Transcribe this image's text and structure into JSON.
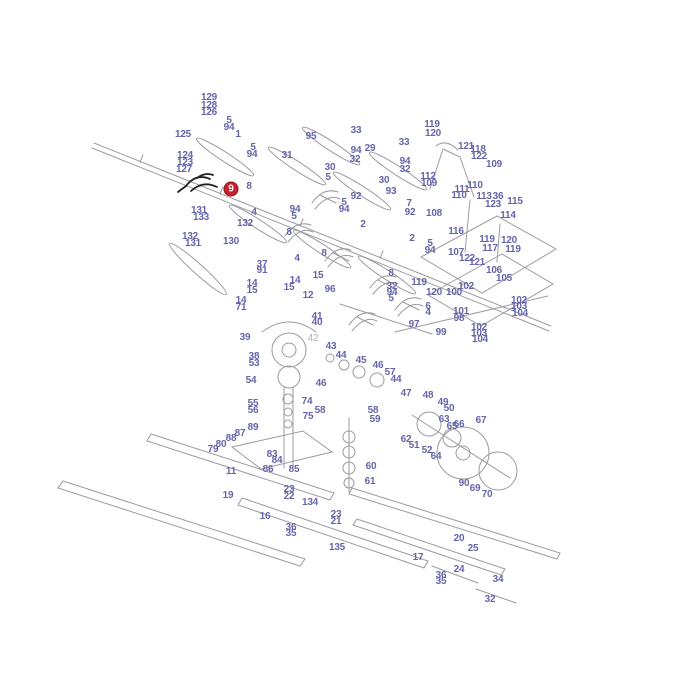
{
  "page": {
    "background": "#ffffff",
    "label_color": "#6565aa",
    "muted_label_color": "#b1b1c4",
    "highlight_color": "#c81f2e",
    "line_color": "#9b9ba3"
  },
  "highlighted_label": {
    "text": "9",
    "x": 231,
    "y": 189
  },
  "labels": [
    {
      "t": "129",
      "x": 209,
      "y": 98
    },
    {
      "t": "128",
      "x": 209,
      "y": 106
    },
    {
      "t": "126",
      "x": 209,
      "y": 113
    },
    {
      "t": "125",
      "x": 183,
      "y": 135
    },
    {
      "t": "5",
      "x": 229,
      "y": 121
    },
    {
      "t": "94",
      "x": 229,
      "y": 128
    },
    {
      "t": "1",
      "x": 238,
      "y": 135
    },
    {
      "t": "124",
      "x": 185,
      "y": 156
    },
    {
      "t": "123",
      "x": 185,
      "y": 163
    },
    {
      "t": "127",
      "x": 184,
      "y": 170
    },
    {
      "t": "8",
      "x": 249,
      "y": 187
    },
    {
      "t": "131",
      "x": 199,
      "y": 211
    },
    {
      "t": "133",
      "x": 201,
      "y": 218
    },
    {
      "t": "4",
      "x": 254,
      "y": 213
    },
    {
      "t": "132",
      "x": 245,
      "y": 224
    },
    {
      "t": "132",
      "x": 190,
      "y": 237
    },
    {
      "t": "131",
      "x": 193,
      "y": 244
    },
    {
      "t": "130",
      "x": 231,
      "y": 242
    },
    {
      "t": "5",
      "x": 253,
      "y": 148
    },
    {
      "t": "94",
      "x": 252,
      "y": 155
    },
    {
      "t": "31",
      "x": 287,
      "y": 156
    },
    {
      "t": "95",
      "x": 311,
      "y": 137
    },
    {
      "t": "33",
      "x": 356,
      "y": 131
    },
    {
      "t": "29",
      "x": 370,
      "y": 149
    },
    {
      "t": "94",
      "x": 356,
      "y": 151
    },
    {
      "t": "32",
      "x": 355,
      "y": 160
    },
    {
      "t": "30",
      "x": 330,
      "y": 168
    },
    {
      "t": "5",
      "x": 328,
      "y": 178
    },
    {
      "t": "33",
      "x": 404,
      "y": 143
    },
    {
      "t": "94",
      "x": 405,
      "y": 162
    },
    {
      "t": "32",
      "x": 405,
      "y": 170
    },
    {
      "t": "30",
      "x": 384,
      "y": 181
    },
    {
      "t": "92",
      "x": 356,
      "y": 197
    },
    {
      "t": "93",
      "x": 391,
      "y": 192
    },
    {
      "t": "5",
      "x": 344,
      "y": 203
    },
    {
      "t": "94",
      "x": 344,
      "y": 210
    },
    {
      "t": "94",
      "x": 295,
      "y": 210
    },
    {
      "t": "5",
      "x": 294,
      "y": 217
    },
    {
      "t": "2",
      "x": 363,
      "y": 225
    },
    {
      "t": "7",
      "x": 409,
      "y": 204
    },
    {
      "t": "92",
      "x": 410,
      "y": 213
    },
    {
      "t": "2",
      "x": 412,
      "y": 239
    },
    {
      "t": "8",
      "x": 289,
      "y": 233
    },
    {
      "t": "8",
      "x": 324,
      "y": 254
    },
    {
      "t": "4",
      "x": 297,
      "y": 259
    },
    {
      "t": "8",
      "x": 391,
      "y": 274
    },
    {
      "t": "32",
      "x": 392,
      "y": 287
    },
    {
      "t": "94",
      "x": 392,
      "y": 293
    },
    {
      "t": "5",
      "x": 391,
      "y": 299
    },
    {
      "t": "96",
      "x": 330,
      "y": 290
    },
    {
      "t": "15",
      "x": 318,
      "y": 276
    },
    {
      "t": "14",
      "x": 295,
      "y": 281
    },
    {
      "t": "15",
      "x": 289,
      "y": 288
    },
    {
      "t": "12",
      "x": 308,
      "y": 296
    },
    {
      "t": "37",
      "x": 262,
      "y": 265
    },
    {
      "t": "91",
      "x": 262,
      "y": 271
    },
    {
      "t": "14",
      "x": 252,
      "y": 284
    },
    {
      "t": "15",
      "x": 252,
      "y": 291
    },
    {
      "t": "14",
      "x": 241,
      "y": 301
    },
    {
      "t": "71",
      "x": 241,
      "y": 308
    },
    {
      "t": "41",
      "x": 317,
      "y": 317
    },
    {
      "t": "40",
      "x": 317,
      "y": 323
    },
    {
      "t": "39",
      "x": 245,
      "y": 338
    },
    {
      "t": "42",
      "x": 313,
      "y": 339,
      "muted": true
    },
    {
      "t": "38",
      "x": 254,
      "y": 357
    },
    {
      "t": "53",
      "x": 254,
      "y": 364
    },
    {
      "t": "54",
      "x": 251,
      "y": 381
    },
    {
      "t": "55",
      "x": 253,
      "y": 404
    },
    {
      "t": "56",
      "x": 253,
      "y": 411
    },
    {
      "t": "43",
      "x": 331,
      "y": 347
    },
    {
      "t": "44",
      "x": 341,
      "y": 356
    },
    {
      "t": "45",
      "x": 361,
      "y": 361
    },
    {
      "t": "46",
      "x": 378,
      "y": 366
    },
    {
      "t": "57",
      "x": 390,
      "y": 373
    },
    {
      "t": "44",
      "x": 396,
      "y": 380
    },
    {
      "t": "46",
      "x": 321,
      "y": 384
    },
    {
      "t": "74",
      "x": 307,
      "y": 402
    },
    {
      "t": "58",
      "x": 320,
      "y": 411
    },
    {
      "t": "75",
      "x": 308,
      "y": 417
    },
    {
      "t": "58",
      "x": 373,
      "y": 411
    },
    {
      "t": "59",
      "x": 375,
      "y": 420
    },
    {
      "t": "60",
      "x": 371,
      "y": 467
    },
    {
      "t": "61",
      "x": 370,
      "y": 482
    },
    {
      "t": "47",
      "x": 406,
      "y": 394
    },
    {
      "t": "48",
      "x": 428,
      "y": 396
    },
    {
      "t": "49",
      "x": 443,
      "y": 403
    },
    {
      "t": "50",
      "x": 449,
      "y": 409
    },
    {
      "t": "63",
      "x": 444,
      "y": 420
    },
    {
      "t": "65",
      "x": 452,
      "y": 427
    },
    {
      "t": "66",
      "x": 459,
      "y": 425
    },
    {
      "t": "67",
      "x": 481,
      "y": 421
    },
    {
      "t": "62",
      "x": 406,
      "y": 440
    },
    {
      "t": "51",
      "x": 414,
      "y": 446
    },
    {
      "t": "52",
      "x": 427,
      "y": 451
    },
    {
      "t": "64",
      "x": 436,
      "y": 457
    },
    {
      "t": "90",
      "x": 464,
      "y": 484
    },
    {
      "t": "69",
      "x": 475,
      "y": 489
    },
    {
      "t": "70",
      "x": 487,
      "y": 495
    },
    {
      "t": "119",
      "x": 432,
      "y": 125
    },
    {
      "t": "120",
      "x": 433,
      "y": 134
    },
    {
      "t": "121",
      "x": 466,
      "y": 147
    },
    {
      "t": "118",
      "x": 478,
      "y": 150
    },
    {
      "t": "122",
      "x": 479,
      "y": 157
    },
    {
      "t": "109",
      "x": 494,
      "y": 165
    },
    {
      "t": "112",
      "x": 428,
      "y": 177
    },
    {
      "t": "109",
      "x": 429,
      "y": 184
    },
    {
      "t": "110",
      "x": 475,
      "y": 186
    },
    {
      "t": "111",
      "x": 462,
      "y": 190
    },
    {
      "t": "110",
      "x": 459,
      "y": 196
    },
    {
      "t": "113",
      "x": 484,
      "y": 197
    },
    {
      "t": "36",
      "x": 498,
      "y": 197
    },
    {
      "t": "123",
      "x": 493,
      "y": 205
    },
    {
      "t": "115",
      "x": 515,
      "y": 202
    },
    {
      "t": "114",
      "x": 508,
      "y": 216
    },
    {
      "t": "108",
      "x": 434,
      "y": 214
    },
    {
      "t": "116",
      "x": 456,
      "y": 232
    },
    {
      "t": "119",
      "x": 487,
      "y": 240
    },
    {
      "t": "117",
      "x": 490,
      "y": 249
    },
    {
      "t": "120",
      "x": 509,
      "y": 241
    },
    {
      "t": "119",
      "x": 513,
      "y": 250
    },
    {
      "t": "107",
      "x": 456,
      "y": 253
    },
    {
      "t": "122",
      "x": 467,
      "y": 259
    },
    {
      "t": "121",
      "x": 477,
      "y": 263
    },
    {
      "t": "106",
      "x": 494,
      "y": 271
    },
    {
      "t": "105",
      "x": 504,
      "y": 279
    },
    {
      "t": "5",
      "x": 430,
      "y": 244
    },
    {
      "t": "94",
      "x": 430,
      "y": 251
    },
    {
      "t": "119",
      "x": 419,
      "y": 283
    },
    {
      "t": "120",
      "x": 434,
      "y": 293
    },
    {
      "t": "100",
      "x": 454,
      "y": 293
    },
    {
      "t": "102",
      "x": 466,
      "y": 287
    },
    {
      "t": "6",
      "x": 428,
      "y": 307
    },
    {
      "t": "4",
      "x": 428,
      "y": 313
    },
    {
      "t": "101",
      "x": 461,
      "y": 312
    },
    {
      "t": "98",
      "x": 459,
      "y": 319
    },
    {
      "t": "97",
      "x": 414,
      "y": 325
    },
    {
      "t": "99",
      "x": 441,
      "y": 333
    },
    {
      "t": "102",
      "x": 519,
      "y": 301
    },
    {
      "t": "103",
      "x": 519,
      "y": 307
    },
    {
      "t": "104",
      "x": 520,
      "y": 314
    },
    {
      "t": "102",
      "x": 479,
      "y": 328
    },
    {
      "t": "103",
      "x": 479,
      "y": 334
    },
    {
      "t": "104",
      "x": 480,
      "y": 340
    },
    {
      "t": "79",
      "x": 213,
      "y": 450
    },
    {
      "t": "80",
      "x": 221,
      "y": 445
    },
    {
      "t": "88",
      "x": 231,
      "y": 439
    },
    {
      "t": "87",
      "x": 240,
      "y": 434
    },
    {
      "t": "89",
      "x": 253,
      "y": 428
    },
    {
      "t": "83",
      "x": 272,
      "y": 455
    },
    {
      "t": "84",
      "x": 277,
      "y": 461
    },
    {
      "t": "86",
      "x": 268,
      "y": 470
    },
    {
      "t": "85",
      "x": 294,
      "y": 470
    },
    {
      "t": "11",
      "x": 231,
      "y": 472
    },
    {
      "t": "19",
      "x": 228,
      "y": 496
    },
    {
      "t": "16",
      "x": 265,
      "y": 517
    },
    {
      "t": "36",
      "x": 291,
      "y": 528
    },
    {
      "t": "35",
      "x": 291,
      "y": 534
    },
    {
      "t": "23",
      "x": 289,
      "y": 490
    },
    {
      "t": "22",
      "x": 289,
      "y": 497
    },
    {
      "t": "134",
      "x": 310,
      "y": 503
    },
    {
      "t": "23",
      "x": 336,
      "y": 515
    },
    {
      "t": "21",
      "x": 336,
      "y": 522
    },
    {
      "t": "135",
      "x": 337,
      "y": 548
    },
    {
      "t": "17",
      "x": 418,
      "y": 558
    },
    {
      "t": "20",
      "x": 459,
      "y": 539
    },
    {
      "t": "25",
      "x": 473,
      "y": 549
    },
    {
      "t": "24",
      "x": 459,
      "y": 570
    },
    {
      "t": "36",
      "x": 441,
      "y": 576
    },
    {
      "t": "35",
      "x": 441,
      "y": 582
    },
    {
      "t": "34",
      "x": 498,
      "y": 580
    },
    {
      "t": "32",
      "x": 490,
      "y": 600
    }
  ]
}
